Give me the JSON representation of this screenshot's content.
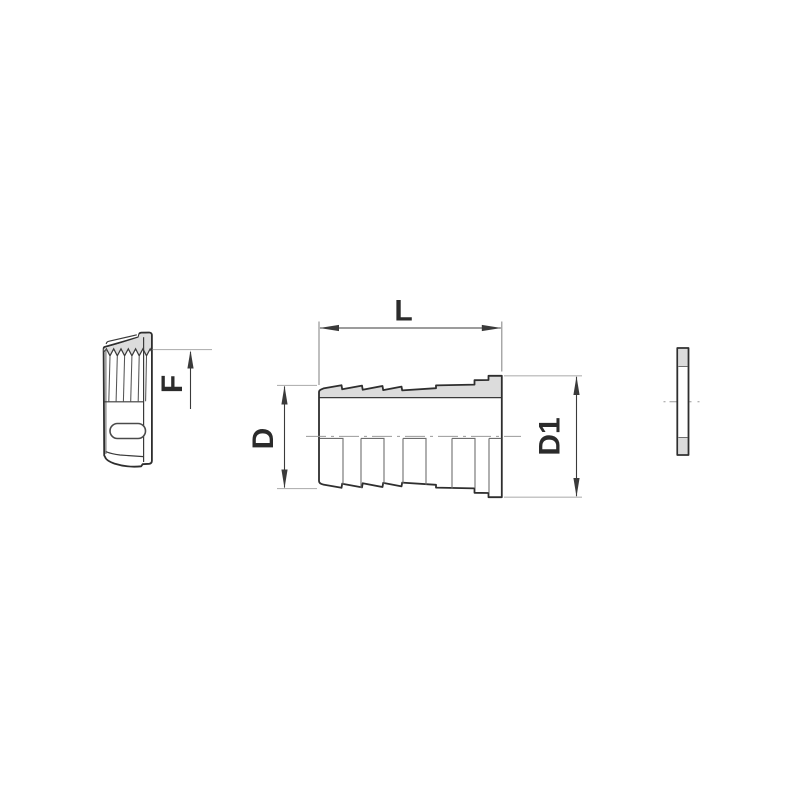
{
  "diagram": {
    "labels": {
      "length_label": "L",
      "thread_label": "F",
      "diameter_label": "D",
      "flange_diameter_label": "D1"
    },
    "colors": {
      "background": "#ffffff",
      "outline": "#2e2e2e",
      "section-fill": "#dcdcdc",
      "dim-line": "#3a3a3a",
      "extension-line": "#b3b3b3",
      "centerline": "#9a9a9a",
      "detail-line": "#6e6e6e",
      "label-text": "#2b2b2b"
    }
  }
}
